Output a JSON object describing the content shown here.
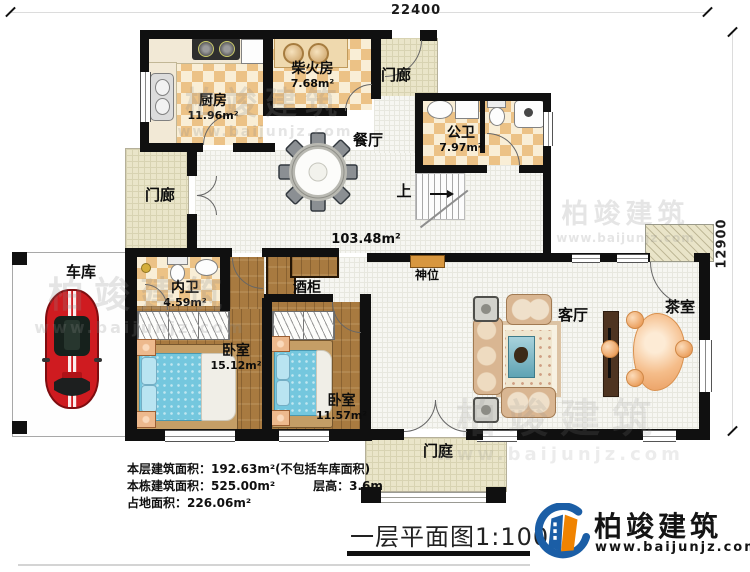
{
  "dimensions": {
    "top": "22400",
    "right": "12900"
  },
  "rooms": {
    "kitchen": {
      "name": "厨房",
      "area": "11.96m²"
    },
    "firewood_room": {
      "name": "柴火房",
      "area": "7.68m²"
    },
    "porch_top": {
      "name": "门廊"
    },
    "porch_left": {
      "name": "门廊"
    },
    "dining_room": {
      "name": "餐厅"
    },
    "public_bathroom": {
      "name": "公卫",
      "area": "7.97m²"
    },
    "stairs_up": {
      "name": "上"
    },
    "hall": {
      "area": "103.48m²"
    },
    "shrine": {
      "name": "神位"
    },
    "garage": {
      "name": "车库"
    },
    "ensuite_bathroom": {
      "name": "内卫",
      "area": "4.59m²"
    },
    "wine_cabinet": {
      "name": "酒柜"
    },
    "bedroom_1": {
      "name": "卧室",
      "area": "15.12m²"
    },
    "bedroom_2": {
      "name": "卧室",
      "area": "11.57m²"
    },
    "living_room": {
      "name": "客厅"
    },
    "tea_room": {
      "name": "茶室"
    },
    "foyer": {
      "name": "门庭"
    }
  },
  "info": {
    "floor_area_label": "本层建筑面积：",
    "floor_area_value": "192.63m²(不包括车库面积)",
    "building_area_label": "本栋建筑面积：",
    "building_area_value": "525.00m²",
    "storey_height_label": "层高：",
    "storey_height_value": "3.6m",
    "land_area_label": "占地面积：",
    "land_area_value": "226.06m²"
  },
  "title": "一层平面图1:100",
  "brand": {
    "name": "柏竣建筑",
    "url": "www.baijunjz.com"
  },
  "watermark": {
    "name": "柏竣建筑",
    "url": "www.baijunjz.com"
  },
  "colors": {
    "wall": "#101010",
    "checker": "#ecc286",
    "wood": "#a87a40",
    "porch_tan": "#eae5c9",
    "mattress_blue": "#74c7de",
    "car_red": "#cf1b20",
    "logo_blue": "#1b5ea6",
    "logo_orange": "#f08300"
  }
}
